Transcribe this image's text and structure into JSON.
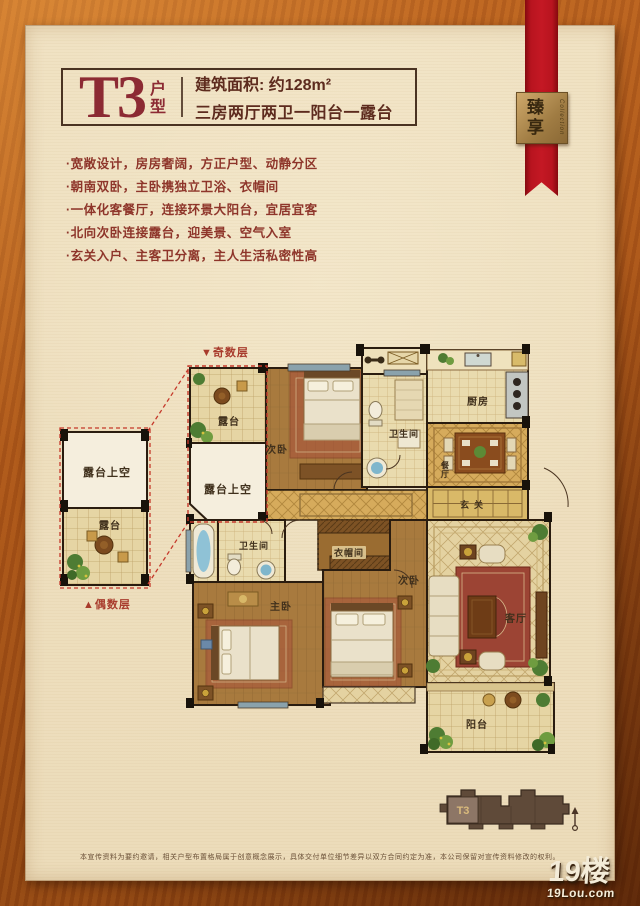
{
  "header": {
    "unit_code": "T3",
    "unit_type_label": "户型",
    "area_line": "建筑面积: 约128m²",
    "layout_line": "三房两厅两卫一阳台一露台"
  },
  "ribbon": {
    "badge_main": "臻享",
    "badge_sub": "Collection"
  },
  "features": [
    "·宽敞设计，房房奢阔，方正户型、动静分区",
    "·朝南双卧，主卧携独立卫浴、衣帽间",
    "·一体化客餐厅，连接环景大阳台，宜居宜客",
    "·北向次卧连接露台，迎美景、空气入室",
    "·玄关入户、主客卫分离，主人生活私密性高"
  ],
  "plan": {
    "odd_floor_label": "▼奇数层",
    "even_floor_label": "▲偶数层",
    "rooms": {
      "terrace": "露台",
      "terrace_void": "露台上空",
      "bedroom_north": "次卧",
      "bath_guest": "卫生间",
      "kitchen": "厨房",
      "dining": "餐厅",
      "entry": "玄关",
      "bath_master": "卫生间",
      "cloakroom": "衣帽间",
      "master": "主卧",
      "bedroom_mid": "次卧",
      "living": "客厅",
      "balcony": "阳台",
      "detail_void": "露台上空",
      "detail_terrace": "露台"
    }
  },
  "building": {
    "unit_label": "T3"
  },
  "footer": {
    "disclaimer": "本宣传资料为要约邀请，相关户型布置格局属于创意概念展示，具体交付单位细节差异以双方合同约定为准，本公司保留对宣传资料修改的权利。",
    "logo_cn": "19楼",
    "logo_url": "19Lou.com"
  },
  "colors": {
    "frame_wood": "#a85418",
    "panel_bg": "#eedfbe",
    "title_red": "#8c2a33",
    "feature_red": "#8e352a",
    "ribbon_red": "#b8141f",
    "badge_gold": "#b28a4e",
    "plan_wall": "#2a1c0f",
    "dash_red": "#c5392b",
    "window_blue": "#8aa2ac",
    "wood_floor": "#a87a3e",
    "tile_cream": "#e9dbae"
  }
}
